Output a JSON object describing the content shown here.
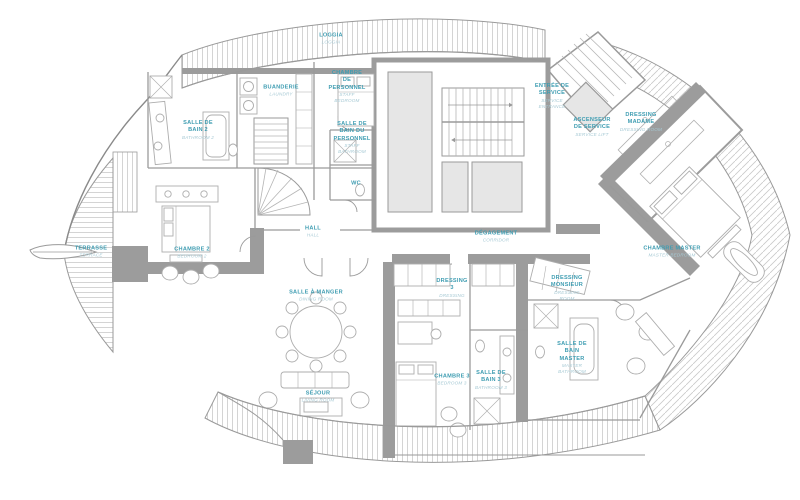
{
  "plan": {
    "title": "Penthouse floor plan",
    "colors": {
      "label": "#3f9db2",
      "sublabel": "#a6c9d4",
      "walls": "#9c9c9c",
      "shaft_fill": "#e6e6e6",
      "hatch": "#c9c9c9",
      "furniture": "#adadad"
    },
    "rooms": [
      {
        "id": "loggia",
        "name": "LOGGIA",
        "sub": "LOGGIA",
        "x": 331,
        "y": 39,
        "w": 40
      },
      {
        "id": "buanderie",
        "name": "BUANDERIE",
        "sub": "LAUNDRY",
        "x": 281,
        "y": 91,
        "w": 44
      },
      {
        "id": "chambre-personnel",
        "name": "CHAMBRE DE PERSONNEL",
        "sub": "STAFF BEDROOM",
        "x": 347,
        "y": 87,
        "w": 38
      },
      {
        "id": "sdb-personnel",
        "name": "SALLE DE BAIN DU PERSONNEL",
        "sub": "STAFF BATHROOM",
        "x": 352,
        "y": 138,
        "w": 38
      },
      {
        "id": "wc",
        "name": "WC",
        "sub": "",
        "x": 356,
        "y": 184,
        "w": 20
      },
      {
        "id": "salle-de-bain-2",
        "name": "SALLE DE BAIN 2",
        "sub": "BATHROOM 2",
        "x": 198,
        "y": 130,
        "w": 34
      },
      {
        "id": "chambre-2",
        "name": "CHAMBRE 2",
        "sub": "BEDROOM 2",
        "x": 192,
        "y": 253,
        "w": 44
      },
      {
        "id": "terrasse",
        "name": "TERRASSE",
        "sub": "TERRACE",
        "x": 91,
        "y": 252,
        "w": 40
      },
      {
        "id": "hall",
        "name": "HALL",
        "sub": "HALL",
        "x": 313,
        "y": 232,
        "w": 30
      },
      {
        "id": "degagement",
        "name": "DÉGAGEMENT",
        "sub": "CORRIDOR",
        "x": 496,
        "y": 237,
        "w": 54
      },
      {
        "id": "entree-service",
        "name": "ENTRÉE DE SERVICE",
        "sub": "SERVICE ENTRANCE",
        "x": 552,
        "y": 96,
        "w": 40
      },
      {
        "id": "ascenseur-service",
        "name": "ASCENSEUR DE SERVICE",
        "sub": "SERVICE LIFT",
        "x": 592,
        "y": 127,
        "w": 38
      },
      {
        "id": "dressing-madame",
        "name": "DRESSING MADAME",
        "sub": "DRESSING ROOM",
        "x": 641,
        "y": 122,
        "w": 46
      },
      {
        "id": "chambre-master",
        "name": "CHAMBRE MASTER",
        "sub": "MASTER BEDROOM",
        "x": 672,
        "y": 252,
        "w": 64
      },
      {
        "id": "salle-a-manger",
        "name": "SALLE À MANGER",
        "sub": "DINING ROOM",
        "x": 316,
        "y": 296,
        "w": 60
      },
      {
        "id": "dressing-3",
        "name": "DRESSING 3",
        "sub": "DRESSING",
        "x": 452,
        "y": 288,
        "w": 36
      },
      {
        "id": "dressing-monsieur",
        "name": "DRESSING MONSIEUR",
        "sub": "DRESSING ROOM",
        "x": 567,
        "y": 288,
        "w": 40
      },
      {
        "id": "sejour",
        "name": "SÉJOUR",
        "sub": "LIVING ROOM",
        "x": 318,
        "y": 397,
        "w": 50
      },
      {
        "id": "chambre-3",
        "name": "CHAMBRE 3",
        "sub": "BEDROOM 3",
        "x": 452,
        "y": 380,
        "w": 36
      },
      {
        "id": "salle-de-bain-3",
        "name": "SALLE DE BAIN 3",
        "sub": "BATHROOM 3",
        "x": 491,
        "y": 380,
        "w": 36
      },
      {
        "id": "sdb-master",
        "name": "SALLE DE BAIN MASTER",
        "sub": "MASTER BATHROOM",
        "x": 572,
        "y": 358,
        "w": 36
      }
    ]
  }
}
